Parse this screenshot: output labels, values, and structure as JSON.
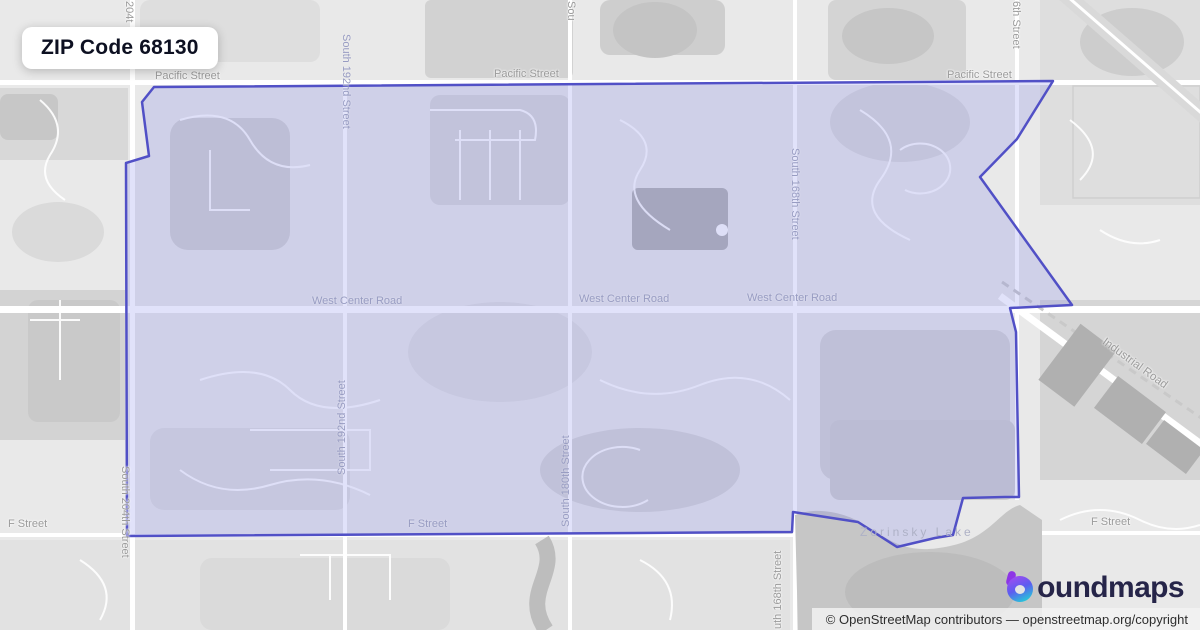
{
  "title_card": {
    "title": "ZIP Code 68130"
  },
  "map": {
    "region": "ZIP Code 68130 highlighted boundary",
    "boundary_color": "#5150c6",
    "boundary_fill": "rgba(112,117,231,0.21)",
    "boundary_points": "154,87 1053,81 1017,139 980,177 1072,305 1010,308 1016,332 1019,497 1005,497 963,498 953,535 935,538 897,547 858,522 793,512 792,532 127,536 126,163 149,156 142,102",
    "labels": [
      {
        "text": "Pacific Street"
      },
      {
        "text": "Pacific Street"
      },
      {
        "text": "Pacific Street"
      },
      {
        "text": "West Center Road"
      },
      {
        "text": "West Center Road"
      },
      {
        "text": "West Center Road"
      },
      {
        "text": "F Street"
      },
      {
        "text": "F Street"
      },
      {
        "text": "F Street"
      },
      {
        "text": "Zorinsky Lake"
      },
      {
        "text": "204t"
      },
      {
        "text": "South 192nd Street"
      },
      {
        "text": "Sou"
      },
      {
        "text": "6th Street"
      },
      {
        "text": "South 168th Street"
      },
      {
        "text": "South 204th Street"
      },
      {
        "text": "South 192nd Street"
      },
      {
        "text": "South 180th Street"
      },
      {
        "text": "uth 168th Street"
      },
      {
        "text": "Industrial Road"
      }
    ]
  },
  "logo": {
    "icon": "boundmaps-b-icon",
    "text": "oundmaps"
  },
  "attribution": {
    "prefix": "© OpenStreetMap contributors",
    "separator": " — ",
    "link": "openstreetmap.org/copyright"
  }
}
